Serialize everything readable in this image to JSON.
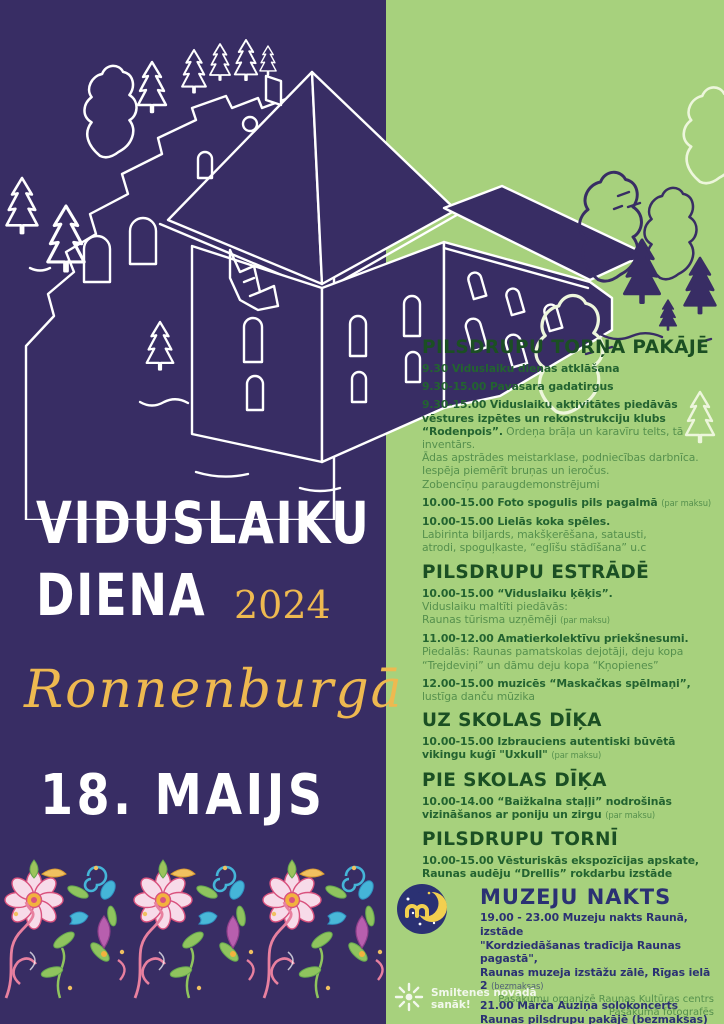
{
  "colors": {
    "purple": "#382d64",
    "green": "#a7d17d",
    "heading-green": "#1b4f23",
    "bold-green": "#236330",
    "reg-green": "#55904d",
    "navy": "#2b3173",
    "gold": "#eeb950",
    "yellow": "#f2cf4f",
    "white": "#ffffff"
  },
  "hero": {
    "title_line1": "VIDUSLAIKU",
    "title_line2": "DIENA",
    "year": "2024",
    "location": "Ronnenburgā",
    "date": "18. MAIJS"
  },
  "schedule": {
    "sections": [
      {
        "heading": "PILSDRUPU TORŅA PAKĀJĒ",
        "theme": "green",
        "items": [
          [
            [
              {
                "t": "9.30 Viduslaiku dienas atklāšana",
                "k": "b"
              }
            ]
          ],
          [
            [
              {
                "t": "9.30-15.00 Pavasara gadatirgus",
                "k": "b"
              }
            ]
          ],
          [
            [
              {
                "t": "9.30-15.00 Viduslaiku aktivitātes piedāvās",
                "k": "b"
              }
            ],
            [
              {
                "t": "vēstures izpētes un rekonstrukciju klubs",
                "k": "b"
              }
            ],
            [
              {
                "t": "“Rodenpois”.",
                "k": "b"
              },
              {
                "t": " Ordeņa brāļa un karavīru telts, tā inventārs.",
                "k": "r"
              }
            ],
            [
              {
                "t": "Ādas apstrādes meistarklase, podniecības darbnīca.",
                "k": "r"
              }
            ],
            [
              {
                "t": "Iespēja piemērīt bruņas un ieročus.",
                "k": "r"
              }
            ],
            [
              {
                "t": "Zobencīņu paraugdemonstrējumi",
                "k": "r"
              }
            ]
          ],
          [
            [
              {
                "t": "10.00-15.00 Foto spogulis pils pagalmā ",
                "k": "b"
              },
              {
                "t": "(par maksu)",
                "k": "s"
              }
            ]
          ],
          [
            [
              {
                "t": "10.00-15.00 Lielās koka spēles.",
                "k": "b"
              }
            ],
            [
              {
                "t": "Labirinta biljards, makšķerēšana, satausti,",
                "k": "r"
              }
            ],
            [
              {
                "t": "atrodi, spoguļkaste, “eglīšu stādīšana” u.c",
                "k": "r"
              }
            ]
          ]
        ]
      },
      {
        "heading": "PILSDRUPU ESTRĀDĒ",
        "theme": "green",
        "items": [
          [
            [
              {
                "t": "10.00-15.00 “Viduslaiku ķēķis”.",
                "k": "b"
              }
            ],
            [
              {
                "t": "Viduslaiku maltīti piedāvās:",
                "k": "r"
              }
            ],
            [
              {
                "t": "Raunas tūrisma uzņēmēji ",
                "k": "r"
              },
              {
                "t": "(par maksu)",
                "k": "s"
              }
            ]
          ],
          [
            [
              {
                "t": "11.00-12.00 Amatierkolektīvu priekšnesumi.",
                "k": "b"
              }
            ],
            [
              {
                "t": "Piedalās: Raunas pamatskolas dejotāji, deju kopa",
                "k": "r"
              }
            ],
            [
              {
                "t": "“Trejdeviņi” un dāmu deju kopa “Kņopienes”",
                "k": "r"
              }
            ]
          ],
          [
            [
              {
                "t": "12.00-15.00 muzicēs “Maskačkas spēlmaņi”,",
                "k": "b"
              }
            ],
            [
              {
                "t": "lustīga danču mūzika",
                "k": "r"
              }
            ]
          ]
        ]
      },
      {
        "heading": "UZ SKOLAS DĪĶA",
        "theme": "green",
        "items": [
          [
            [
              {
                "t": "10.00-15.00 Izbrauciens autentiski būvētā",
                "k": "b"
              }
            ],
            [
              {
                "t": "vikingu kuģī \"Uxkull\" ",
                "k": "b"
              },
              {
                "t": "(par maksu)",
                "k": "s"
              }
            ]
          ]
        ]
      },
      {
        "heading": "PIE SKOLAS DĪĶA",
        "theme": "green",
        "items": [
          [
            [
              {
                "t": "10.00-14.00 “Baižkalna staļļi” nodrošinās",
                "k": "b"
              }
            ],
            [
              {
                "t": "vizināšanos ar poniju un zirgu ",
                "k": "b"
              },
              {
                "t": "(par maksu)",
                "k": "s"
              }
            ]
          ]
        ]
      },
      {
        "heading": "PILSDRUPU TORNĪ",
        "theme": "green",
        "items": [
          [
            [
              {
                "t": "10.00-15.00 Vēsturiskās ekspozīcijas apskate,",
                "k": "b"
              }
            ],
            [
              {
                "t": "Raunas audēju “Drellis” rokdarbu izstāde",
                "k": "b"
              }
            ]
          ]
        ]
      },
      {
        "heading": "MUZEJU NAKTS",
        "theme": "navy",
        "icon": "moon-icon",
        "items": [
          [
            [
              {
                "t": "19.00 - 23.00 Muzeju nakts Raunā, izstāde",
                "k": "b"
              }
            ],
            [
              {
                "t": "\"Kordziedāšanas tradīcija Raunas pagastā\",",
                "k": "b"
              }
            ],
            [
              {
                "t": "Raunas muzeja izstāžu zālē, Rīgas ielā 2 ",
                "k": "b"
              },
              {
                "t": "(bezmaksas)",
                "k": "s"
              }
            ]
          ],
          [
            [
              {
                "t": "21.00 Mārča Auziņa solokoncerts",
                "k": "b"
              }
            ],
            [
              {
                "t": "Raunas pilsdrupu pakājē (bezmaksas)",
                "k": "b"
              }
            ]
          ]
        ]
      }
    ]
  },
  "footer": {
    "community_logo": {
      "icon": "sunburst-icon",
      "line1": "Smiltenes novadā",
      "line2": "sanāk!"
    },
    "organizer_line1": "Pasākumu organizē Raunas Kultūras centrs",
    "organizer_line2": "Pasākumā fotografēs"
  },
  "illustrations": {
    "castle": "castle-ruins-line-art",
    "folk_border": "latvian-folk-ornament-border",
    "muzeju_nakts_icon": "moon-icon"
  },
  "folk_palette": [
    "#e8809f",
    "#d9527e",
    "#f7dbe9",
    "#8fc45e",
    "#66a84f",
    "#45b5d8",
    "#2f8fc0",
    "#b85fae",
    "#f2b23e",
    "#f0c060"
  ]
}
